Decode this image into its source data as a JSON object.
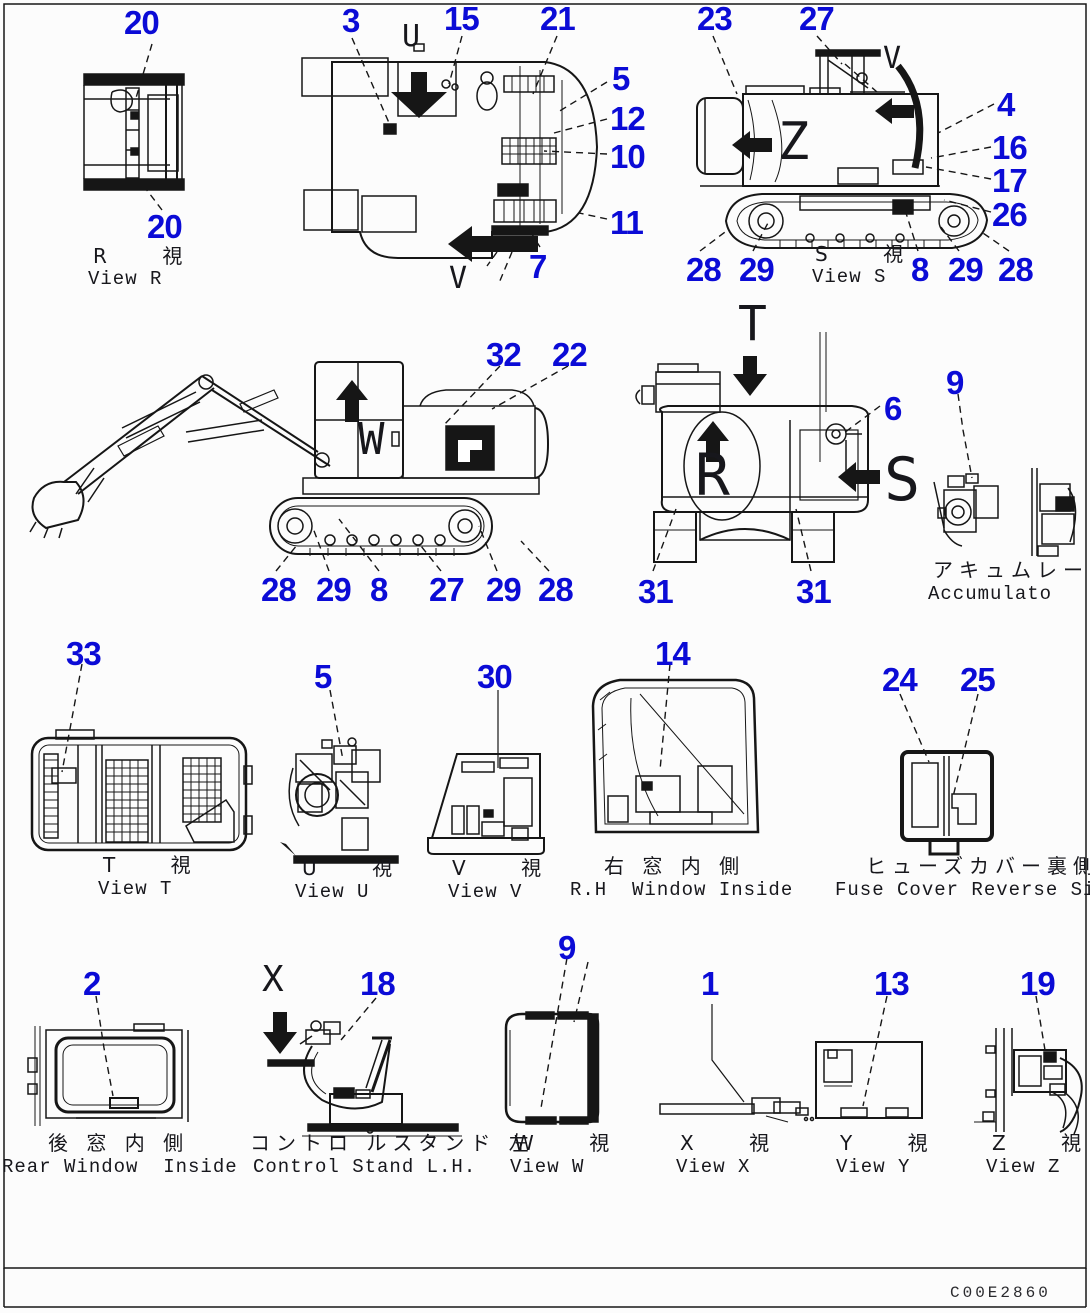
{
  "doc": {
    "code": "C00E2860"
  },
  "palette": {
    "callout_blue": "#0b0bd6",
    "line_black": "#161616",
    "paper": "#fcfcfc"
  },
  "callouts": [
    "20",
    "3",
    "15",
    "21",
    "5",
    "12",
    "10",
    "11",
    "7",
    "20",
    "23",
    "27",
    "4",
    "16",
    "17",
    "26",
    "28",
    "29",
    "8",
    "29",
    "28",
    "32",
    "22",
    "9",
    "6",
    "28",
    "29",
    "8",
    "27",
    "29",
    "28",
    "31",
    "31",
    "33",
    "5",
    "30",
    "14",
    "24",
    "25",
    "2",
    "18",
    "9",
    "1",
    "13",
    "19"
  ],
  "letters": [
    "U",
    "V",
    "V",
    "Z",
    "T",
    "R",
    "S",
    "W",
    "X"
  ],
  "views": {
    "view_r": {
      "jp": "R    視",
      "en": "View R"
    },
    "view_s": {
      "jp": "S    視",
      "en": "View S"
    },
    "view_t": {
      "jp": "T    視",
      "en": "View T"
    },
    "view_u": {
      "jp": "U    視",
      "en": "View U"
    },
    "view_v": {
      "jp": "V    視",
      "en": "View V"
    },
    "view_w": {
      "jp": "W    視",
      "en": "View W"
    },
    "view_x": {
      "jp": "X    視",
      "en": "View X"
    },
    "view_y": {
      "jp": "Y    視",
      "en": "View Y"
    },
    "view_z": {
      "jp": "Z    視",
      "en": "View Z"
    },
    "rh_window": {
      "jp": "右 窓 内 側",
      "en": "R.H  Window Inside"
    },
    "fuse_cover": {
      "jp": "ヒューズカバー裏側",
      "en": "Fuse Cover Reverse Side"
    },
    "rear_window": {
      "jp": "後 窓 内 側",
      "en": "Rear Window  Inside"
    },
    "control_stand": {
      "jp": "コントロ ルスタンド 左",
      "en": "Control Stand L.H."
    },
    "accumulator": {
      "jp": "アキュムレータ",
      "en": "Accumulato"
    }
  }
}
